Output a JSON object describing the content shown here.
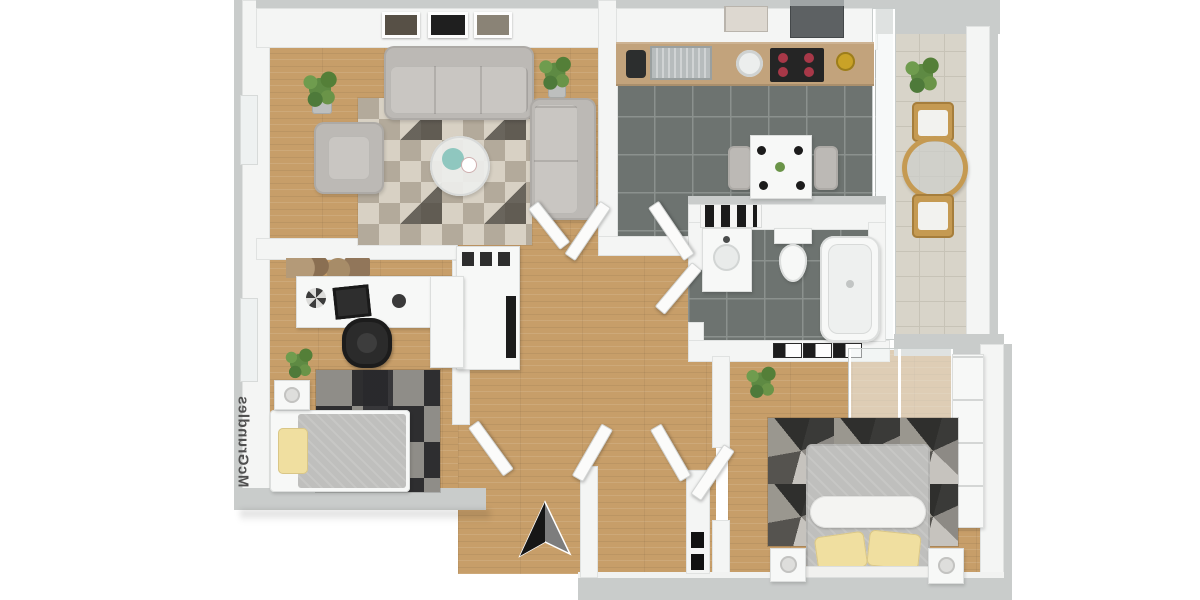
{
  "watermark": {
    "text": "McGrundles"
  },
  "palette": {
    "wood": "#c79e69",
    "tile_dark": "#6d7370",
    "tile_grout": "#8b918e",
    "tile_light": "#d8d4c9",
    "wall_top": "#c9cccb",
    "wall_face": "#f4f5f4",
    "sofa": "#bcb9b5",
    "rug_beige": "#d8d1c4",
    "rug_taupe": "#b3aa9b",
    "rug_dark": "#4a463f",
    "counter": "#c2a37c",
    "blanket": "#bfbfbd",
    "pillow_yellow": "#f0dfa0",
    "plant_a": "#5e8a43",
    "plant_b": "#6f9c4e",
    "burner": "#a83848",
    "gold": "#c9a227",
    "chair_wood": "#c59a52",
    "arrow_dark": "#161616",
    "watermark": "#4f4f4f"
  },
  "scene": {
    "type": "3d-floor-plan-render",
    "rooms": [
      {
        "name": "living-room",
        "floor": "wood",
        "furniture": [
          "three-seat-sofa",
          "chaise-sofa",
          "armchair",
          "round-coffee-table",
          "geometric-rug",
          "potted-plant",
          "potted-plant",
          "picture-frames-x3"
        ]
      },
      {
        "name": "kitchen",
        "floor": "dark-tile",
        "furniture": [
          "counter-with-sink",
          "cooktop-4-burners",
          "round-bowl",
          "faucet",
          "coffee-machine",
          "cutting-boards",
          "dining-table",
          "chair",
          "chair",
          "gold-decor"
        ]
      },
      {
        "name": "balcony",
        "floor": "light-tile",
        "furniture": [
          "round-bistro-table",
          "wood-chair",
          "wood-chair",
          "potted-plant"
        ]
      },
      {
        "name": "bathroom",
        "floor": "dark-tile",
        "furniture": [
          "bathtub",
          "toilet",
          "vanity-sink",
          "radiator",
          "towel-plaques-x3"
        ]
      },
      {
        "name": "office-bedroom",
        "floor": "wood",
        "furniture": [
          "l-shaped-desk",
          "office-chair",
          "laptop",
          "wall-art",
          "single-bed",
          "nightstand-with-lamp",
          "dark-rug",
          "potted-plant"
        ]
      },
      {
        "name": "master-bedroom",
        "floor": "wood",
        "furniture": [
          "double-bed",
          "yellow-pillows-x2",
          "roll-pillow",
          "nightstand-with-lamp",
          "nightstand-with-lamp",
          "geometric-dark-rug",
          "wardrobe",
          "glass-closet",
          "potted-plant"
        ]
      },
      {
        "name": "hallway-entry",
        "floor": "wood",
        "furniture": [
          "sideboard-cabinet",
          "open-doors",
          "intercom-panel"
        ]
      }
    ],
    "annotations": [
      "north-arrow",
      "watermark-text"
    ]
  }
}
